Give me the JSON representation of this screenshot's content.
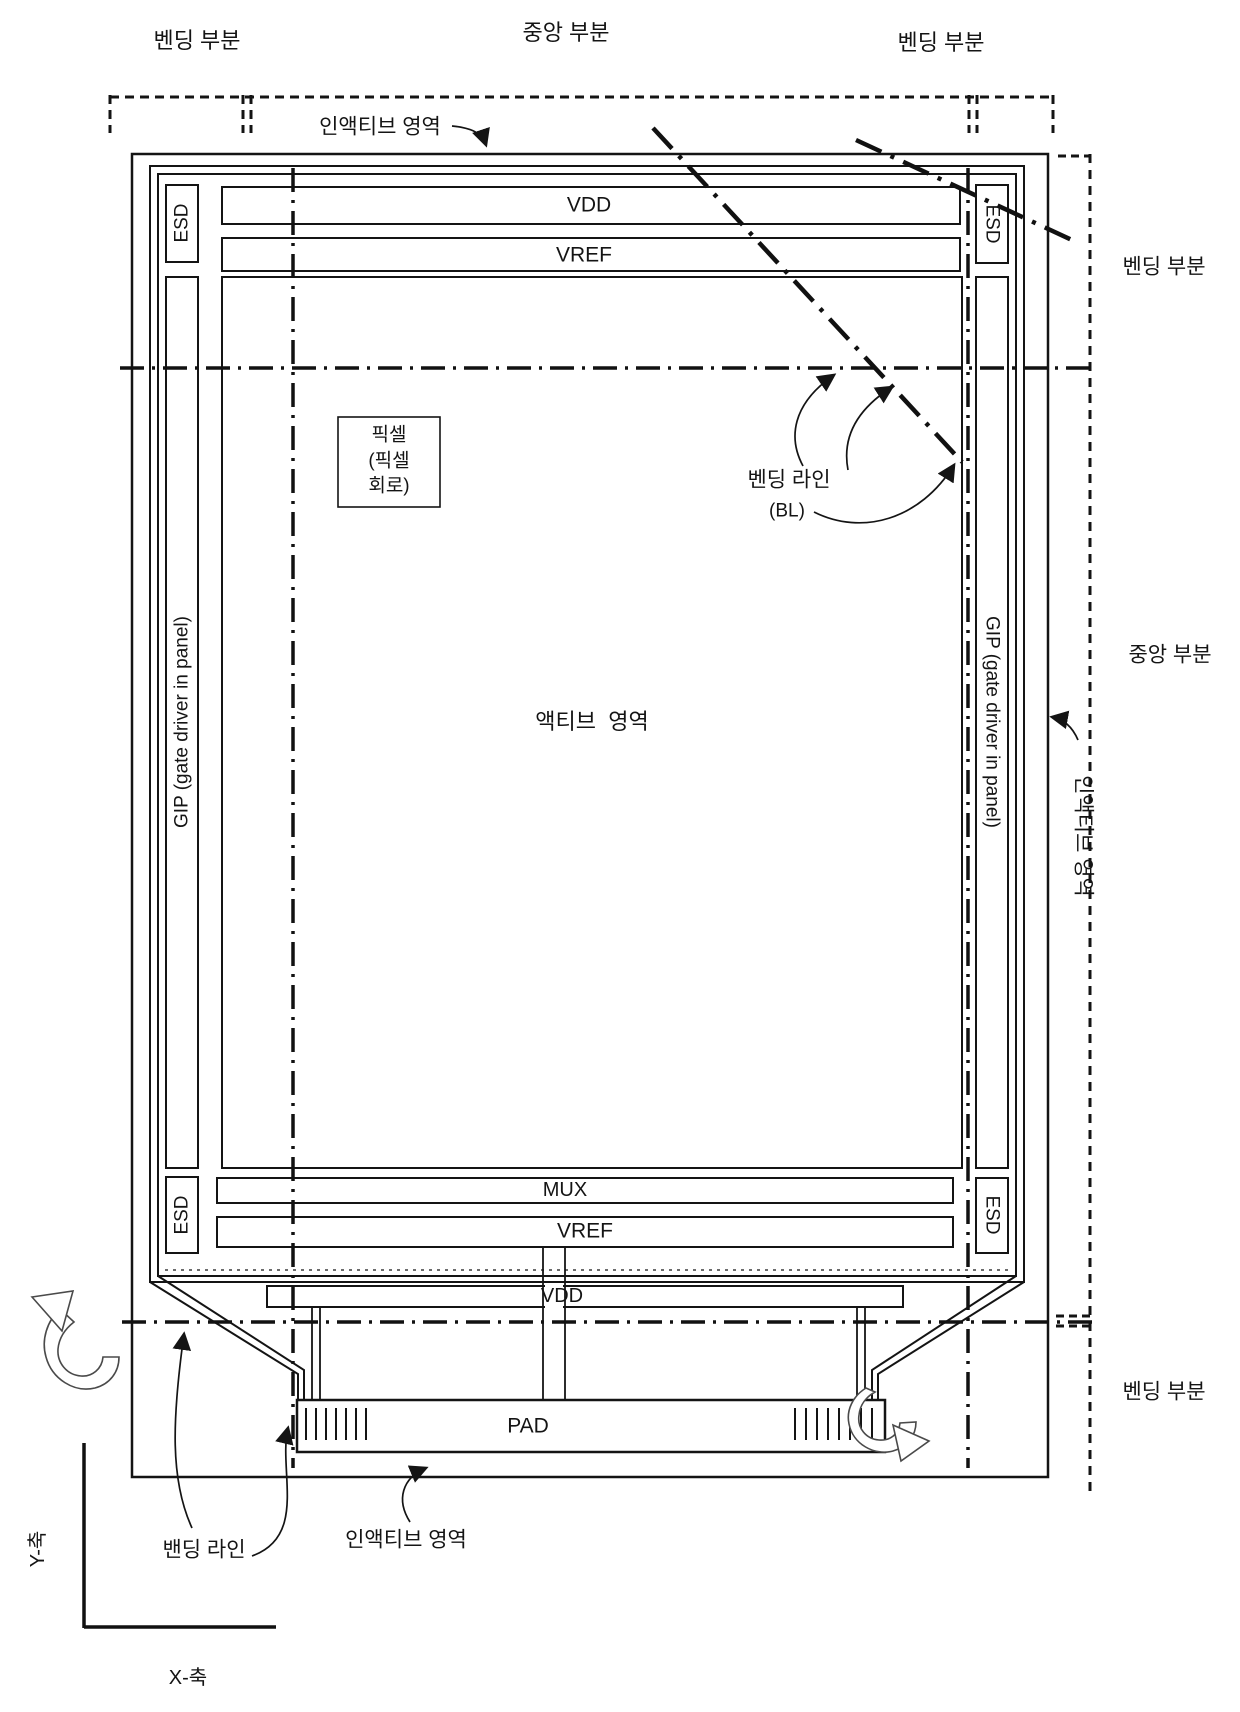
{
  "figure": {
    "top_labels": {
      "bending_left": "벤딩 부분",
      "center": "중앙 부분",
      "bending_right": "벤딩 부분",
      "inactive_area": "인액티브 영역"
    },
    "right_labels": {
      "bending_top": "벤딩 부분",
      "center": "중앙 부분",
      "bending_bottom": "벤딩 부분",
      "inactive_area_vertical": "인액티브 영역"
    },
    "panel": {
      "vdd_top": "VDD",
      "vref_top": "VREF",
      "esd": "ESD",
      "gip": "GIP (gate driver in panel)",
      "pixel_box": {
        "line1": "픽셀",
        "line2": "(픽셀",
        "line3": "회로)"
      },
      "bending_line_label": "벤딩 라인",
      "bending_line_abbr": "(BL)",
      "active_area": "액티브  영역",
      "mux": "MUX",
      "vref_bottom": "VREF",
      "vdd_bottom": "VDD",
      "pad": "PAD"
    },
    "bottom_labels": {
      "banding_line": "밴딩 라인",
      "inactive_area": "인액티브 영역"
    },
    "axes": {
      "y": "Y-축",
      "x": "X-축"
    }
  }
}
